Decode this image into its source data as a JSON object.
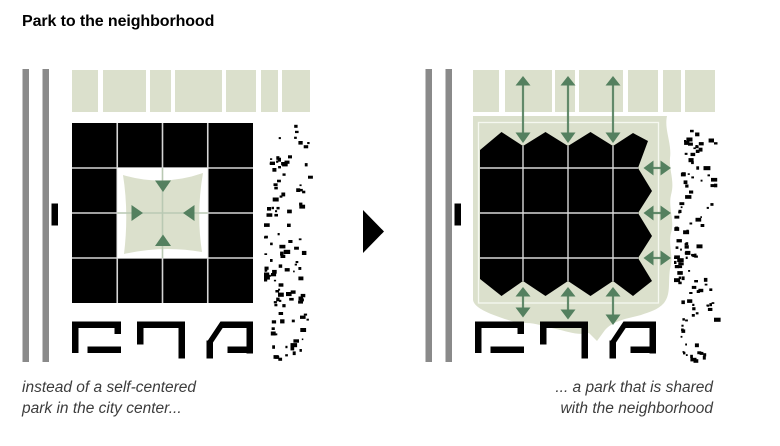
{
  "title": "Park to the neighborhood",
  "panels": {
    "left": {
      "caption_line1": "instead of a self-centered",
      "caption_line2": "park in the city center..."
    },
    "right": {
      "caption_line1": "... a park that is shared",
      "caption_line2": "with the neighborhood"
    }
  },
  "icons": {
    "transition_arrow": "black-right-triangle",
    "park_arrows_left_panel": "four-inward-arrows",
    "park_arrows_right_panel": "double-headed-exchange-arrows"
  },
  "colors": {
    "park_green": "#dbe0cc",
    "arrow_green": "#54805f",
    "road_gray": "#8a8a8a",
    "building_black": "#000000",
    "grid_line": "#d5d5d5",
    "pale_line": "#b9c9b3",
    "caption_text": "#3c3c3c",
    "title_text": "#000000"
  }
}
